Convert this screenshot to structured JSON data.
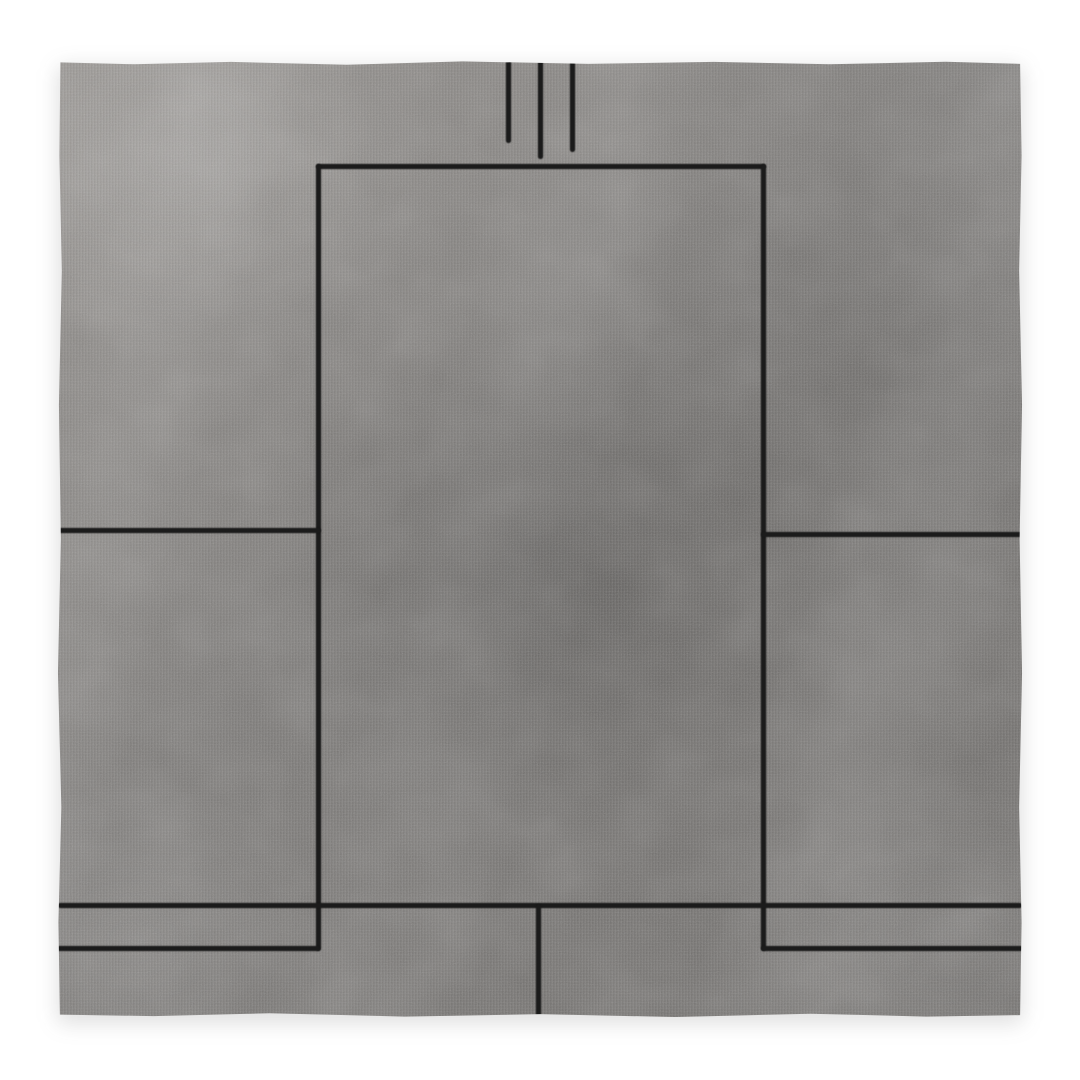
{
  "scene": {
    "description": "Studio product photo of a square grey hand-woven rug with a black geometric line pattern on a plain white background",
    "background_color": "#ffffff"
  },
  "rug": {
    "bounds": {
      "left": 57,
      "top": 60,
      "width": 966,
      "height": 958
    },
    "colors": {
      "highlight": "#918e8b",
      "base": "#7d7b79",
      "dark": "#6f6d6b",
      "line": "#1b1b1b"
    },
    "pattern_lines": [
      {
        "name": "pattern-top-vertical-left",
        "x": 449,
        "y": 0,
        "w": 5,
        "h": 83
      },
      {
        "name": "pattern-top-vertical-middle",
        "x": 481,
        "y": 0,
        "w": 5,
        "h": 99
      },
      {
        "name": "pattern-top-vertical-right",
        "x": 513,
        "y": 0,
        "w": 5,
        "h": 92
      },
      {
        "name": "pattern-center-rect-top",
        "x": 259,
        "y": 104,
        "w": 450,
        "h": 5
      },
      {
        "name": "pattern-center-rect-left",
        "x": 259,
        "y": 104,
        "w": 5,
        "h": 787
      },
      {
        "name": "pattern-center-rect-right",
        "x": 704,
        "y": 104,
        "w": 5,
        "h": 787
      },
      {
        "name": "pattern-left-mid-horizontal",
        "x": 0,
        "y": 468,
        "w": 264,
        "h": 5
      },
      {
        "name": "pattern-right-mid-horizontal",
        "x": 704,
        "y": 472,
        "w": 262,
        "h": 5
      },
      {
        "name": "pattern-bottom-full-horizontal",
        "x": 1,
        "y": 843,
        "w": 964,
        "h": 5
      },
      {
        "name": "pattern-bottom-left-horizontal",
        "x": 0,
        "y": 886,
        "w": 263,
        "h": 5
      },
      {
        "name": "pattern-bottom-right-horizontal",
        "x": 704,
        "y": 886,
        "w": 262,
        "h": 5
      },
      {
        "name": "pattern-bottom-center-vertical",
        "x": 479,
        "y": 844,
        "w": 5,
        "h": 114
      }
    ]
  }
}
